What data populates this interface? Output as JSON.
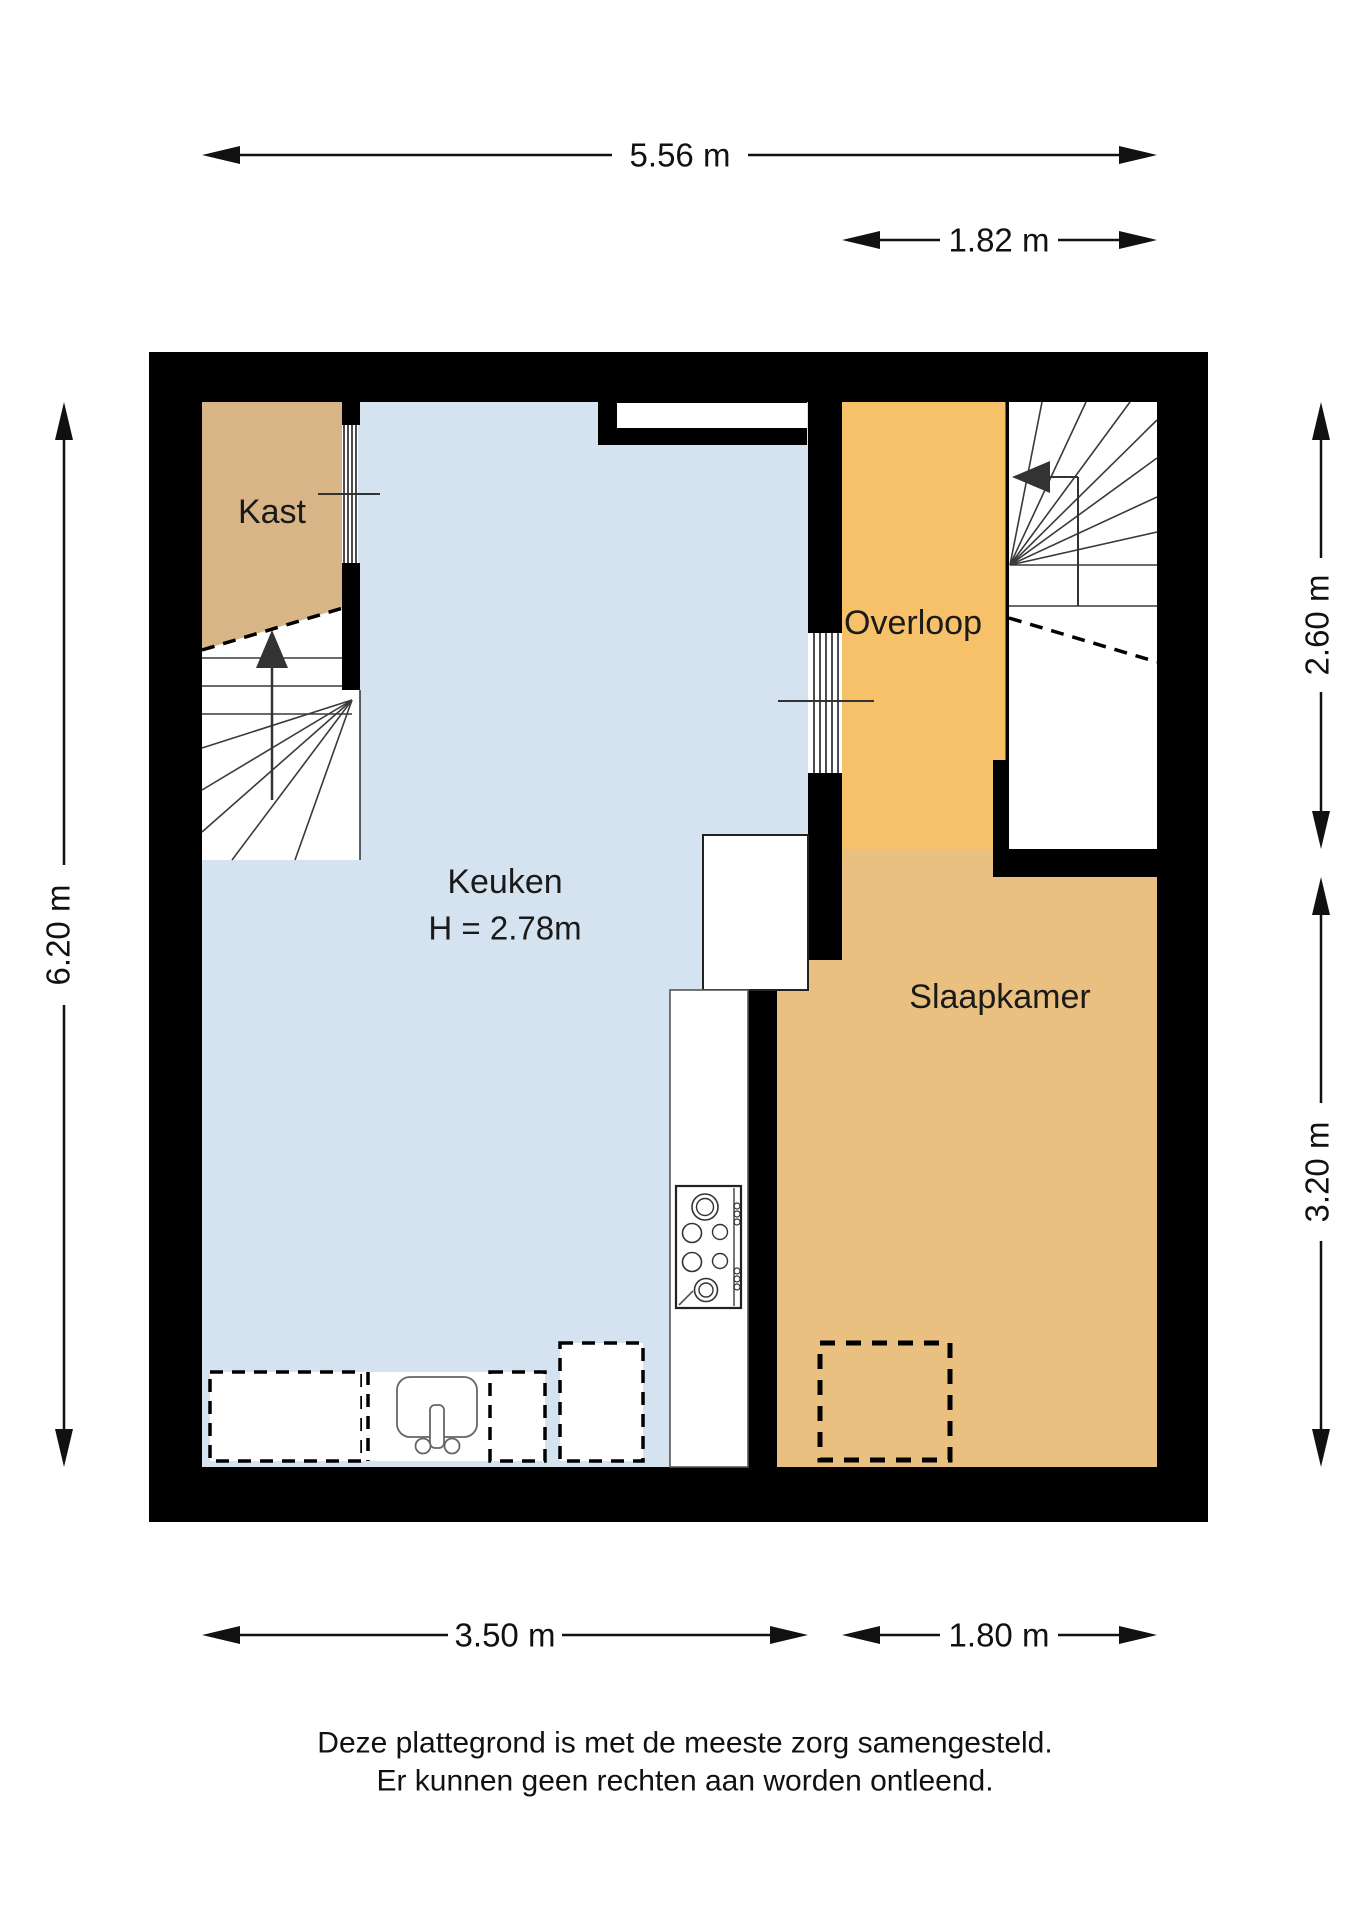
{
  "page": {
    "background": "#ffffff"
  },
  "colors": {
    "wall": "#000000",
    "kast": "#d7b586",
    "keuken": "#d5e2ef",
    "overloop": "#f6c169",
    "slaapkamer": "#e9c080",
    "stairs": "#ffffff"
  },
  "rooms": {
    "kast": {
      "label": "Kast"
    },
    "keuken": {
      "label": "Keuken",
      "ceiling_height": "H = 2.78m"
    },
    "overloop": {
      "label": "Overloop"
    },
    "slaapkamer": {
      "label": "Slaapkamer"
    }
  },
  "dimensions": {
    "top_total_width": "5.56 m",
    "top_right_width": "1.82 m",
    "left_total_height": "6.20 m",
    "right_upper_height": "2.60 m",
    "right_lower_height": "3.20 m",
    "bottom_left_width": "3.50 m",
    "bottom_right_width": "1.80 m"
  },
  "footer": {
    "line1": "Deze plattegrond is met de meeste zorg samengesteld.",
    "line2": "Er kunnen geen rechten aan worden ontleend."
  }
}
